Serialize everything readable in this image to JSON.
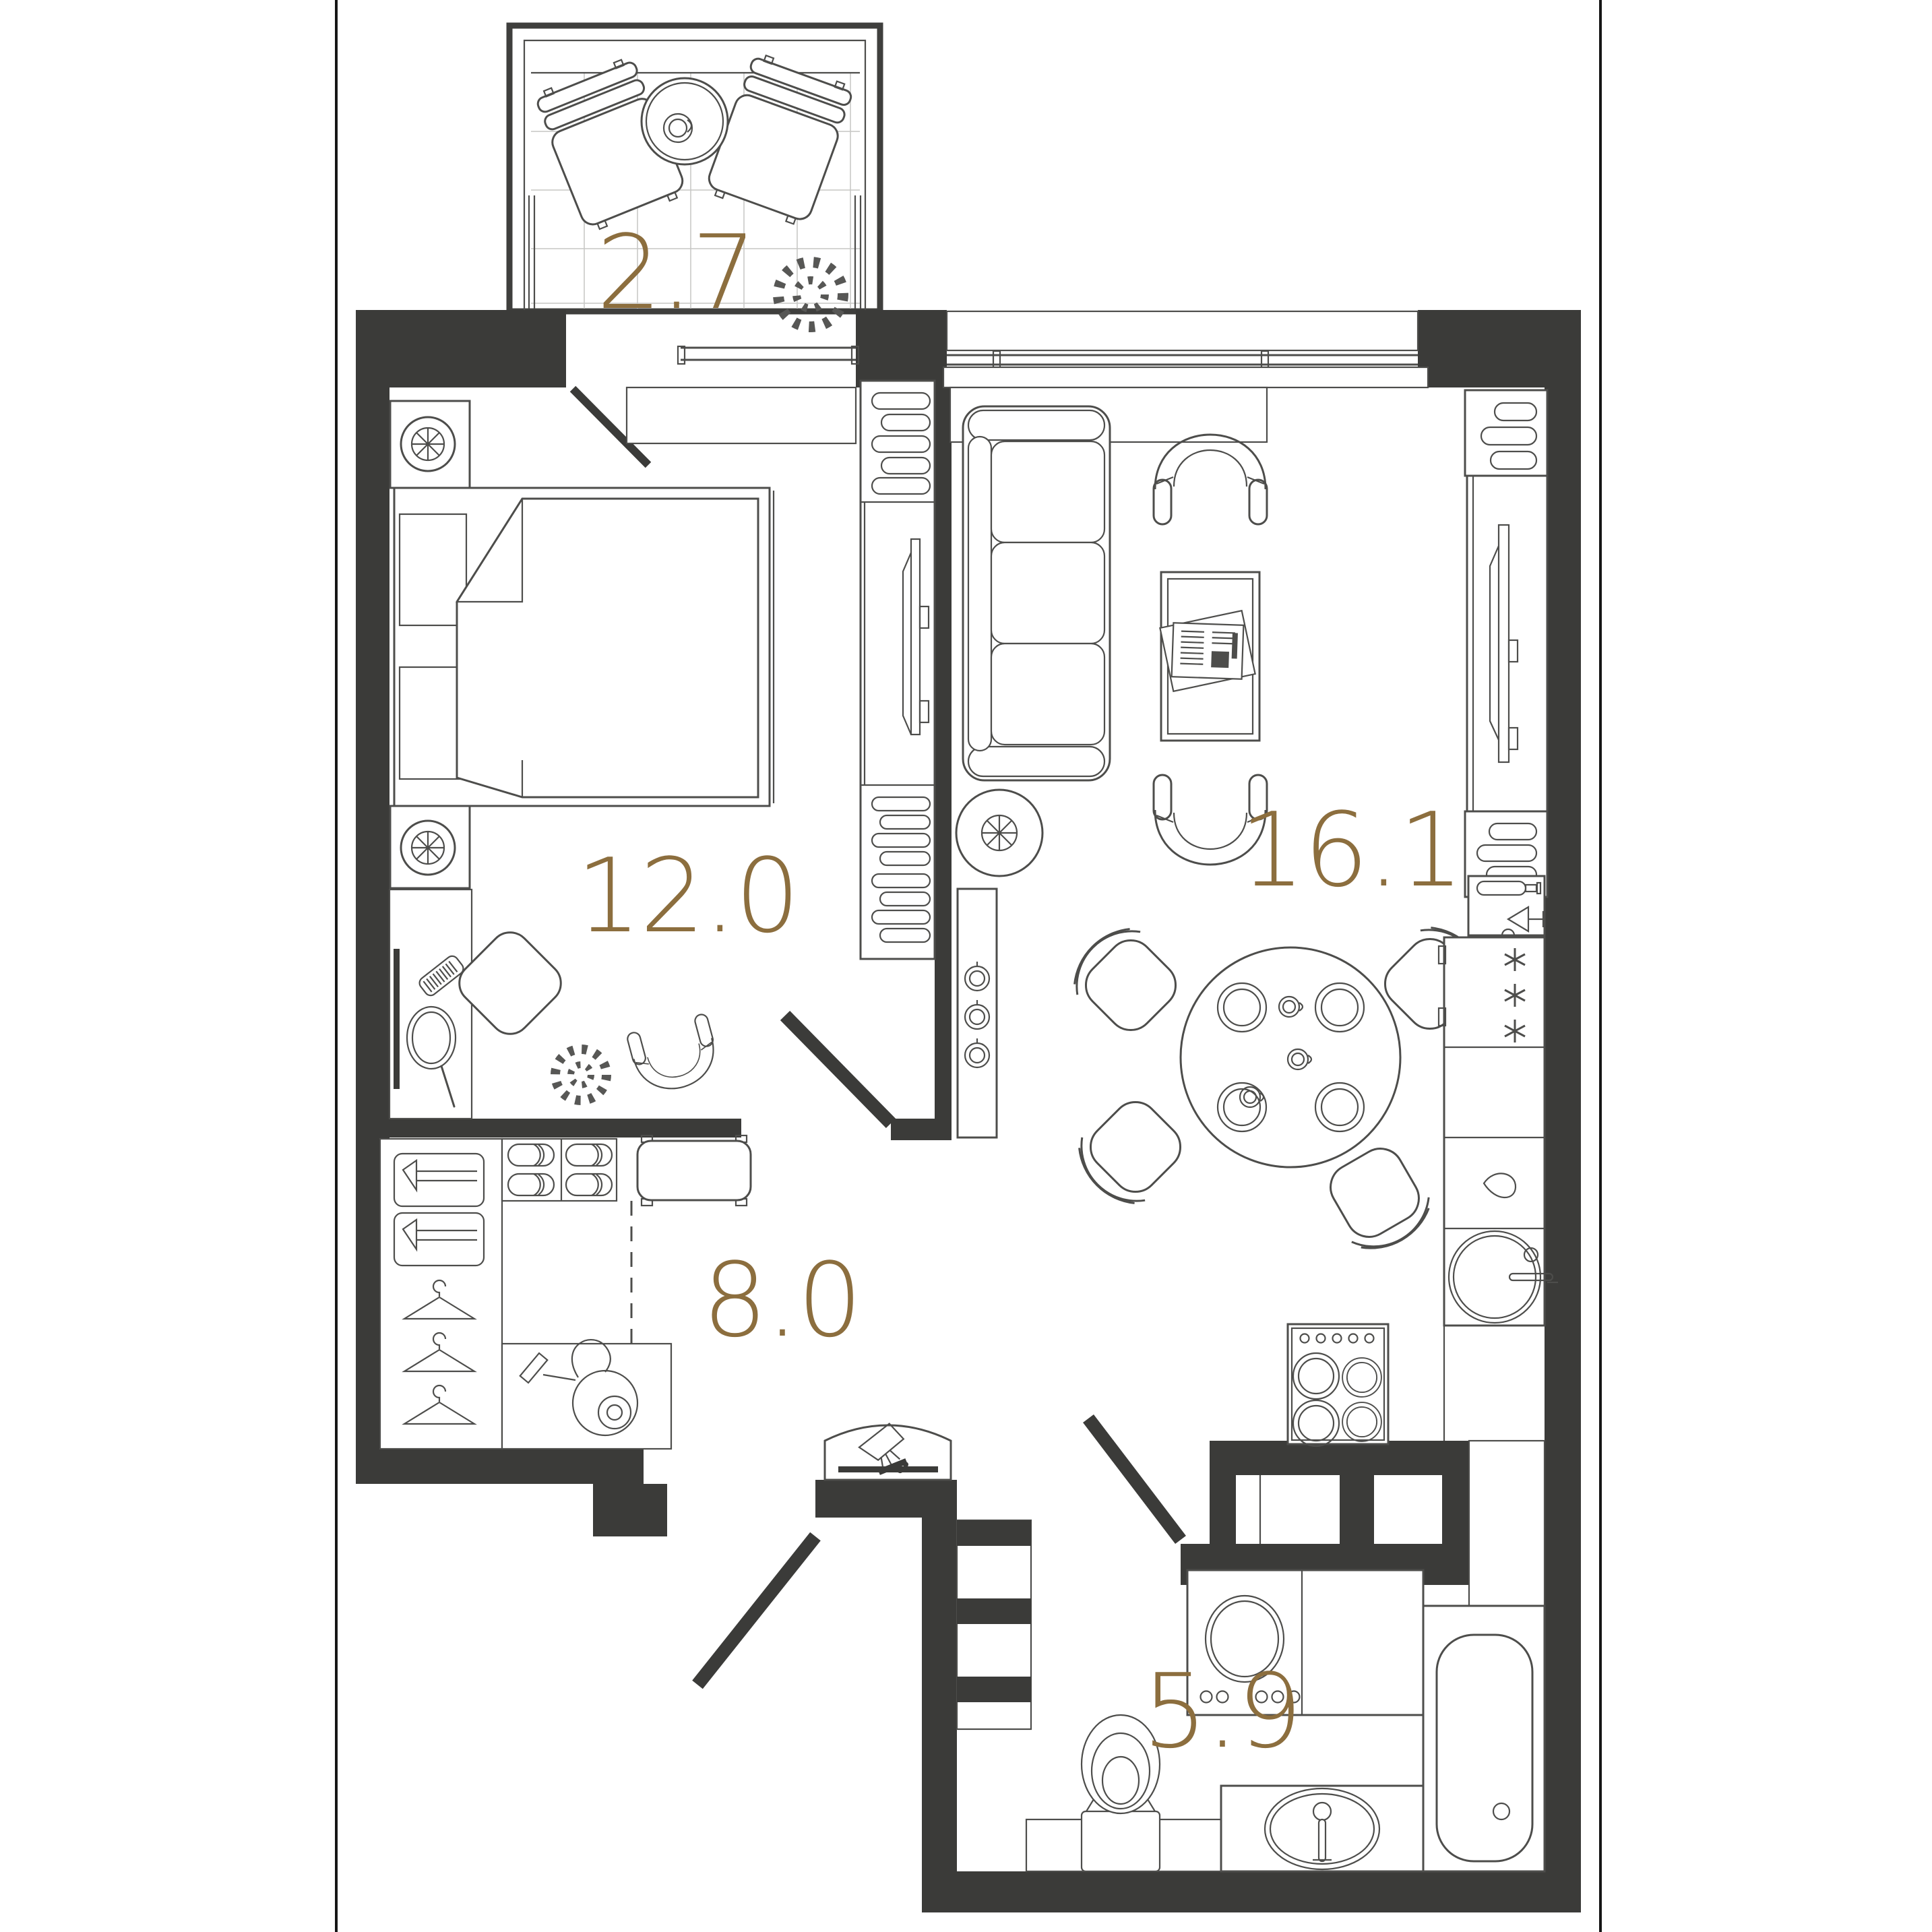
{
  "page": {
    "background": "#ffffff",
    "border_color": "#161616"
  },
  "plan": {
    "type": "apartment-floor-plan",
    "accent_color": "#8c6e3e",
    "wall_color": "#3b3b39",
    "line_color": "#4d4d4b",
    "rooms": [
      {
        "id": "balcony",
        "area_label": "2.7",
        "furniture": [
          "lounge-chair",
          "lounge-chair",
          "round-table",
          "cup",
          "plant"
        ]
      },
      {
        "id": "bedroom",
        "area_label": "12.0",
        "furniture": [
          "double-bed",
          "pillow",
          "pillow",
          "nightstand-lamp",
          "nightstand-lamp",
          "vanity-table",
          "wall-mirror",
          "comb",
          "hand-mirror",
          "pouf",
          "plant",
          "armchair",
          "shelving-tv-cabinet"
        ]
      },
      {
        "id": "living-kitchen",
        "area_label": "16.1",
        "furniture": [
          "sofa",
          "armchair",
          "armchair",
          "coffee-table",
          "magazine",
          "floor-lamp",
          "radiator-panel",
          "dining-table",
          "plates",
          "cups",
          "dining-chair",
          "dining-chair",
          "dining-chair",
          "dining-chair",
          "tv-cabinet",
          "shelf",
          "wine-shelf",
          "fridge",
          "cabinet",
          "dishwasher",
          "sink-round",
          "hob-4-burners"
        ]
      },
      {
        "id": "hallway",
        "area_label": "8.0",
        "furniture": [
          "wardrobe",
          "clothes-boxes",
          "hangers",
          "slipper-shelf",
          "shoe-bench",
          "vacuum-cleaner",
          "entry-lamp"
        ]
      },
      {
        "id": "bathroom",
        "area_label": "5.9",
        "furniture": [
          "washing-machine",
          "counter",
          "toilet",
          "sink-oval",
          "bathtub",
          "duct-shaft"
        ]
      }
    ]
  }
}
